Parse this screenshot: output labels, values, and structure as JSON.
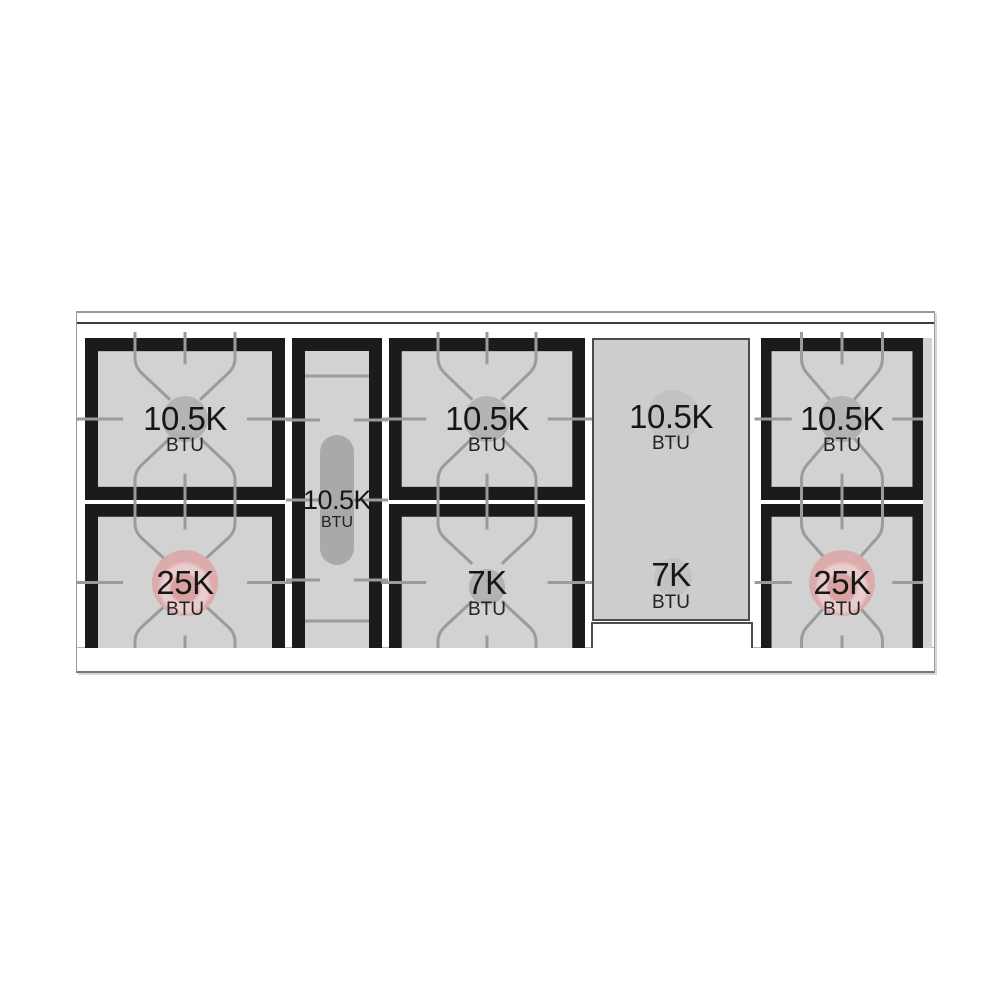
{
  "diagram_title": "gas rangetop burner layout",
  "burners": {
    "left_top": {
      "value": "10.5K",
      "unit": "BTU"
    },
    "left_bottom": {
      "value": "25K",
      "unit": "BTU"
    },
    "center": {
      "value": "10.5K",
      "unit": "BTU"
    },
    "middle_top": {
      "value": "10.5K",
      "unit": "BTU"
    },
    "middle_bottom": {
      "value": "7K",
      "unit": "BTU"
    },
    "griddle_top": {
      "value": "10.5K",
      "unit": "BTU"
    },
    "griddle_bottom": {
      "value": "7K",
      "unit": "BTU"
    },
    "right_top": {
      "value": "10.5K",
      "unit": "BTU"
    },
    "right_bottom": {
      "value": "25K",
      "unit": "BTU"
    }
  },
  "colors": {
    "frame": "#1b1b1b",
    "surface": "#d2d2d2",
    "grate-line": "#9b9b9b",
    "burner-gray": "#ababab",
    "burner-pink": "#dcabab",
    "griddle": "#cdcdcd",
    "text": "#161616",
    "trim-border": "#9a9a9a"
  }
}
